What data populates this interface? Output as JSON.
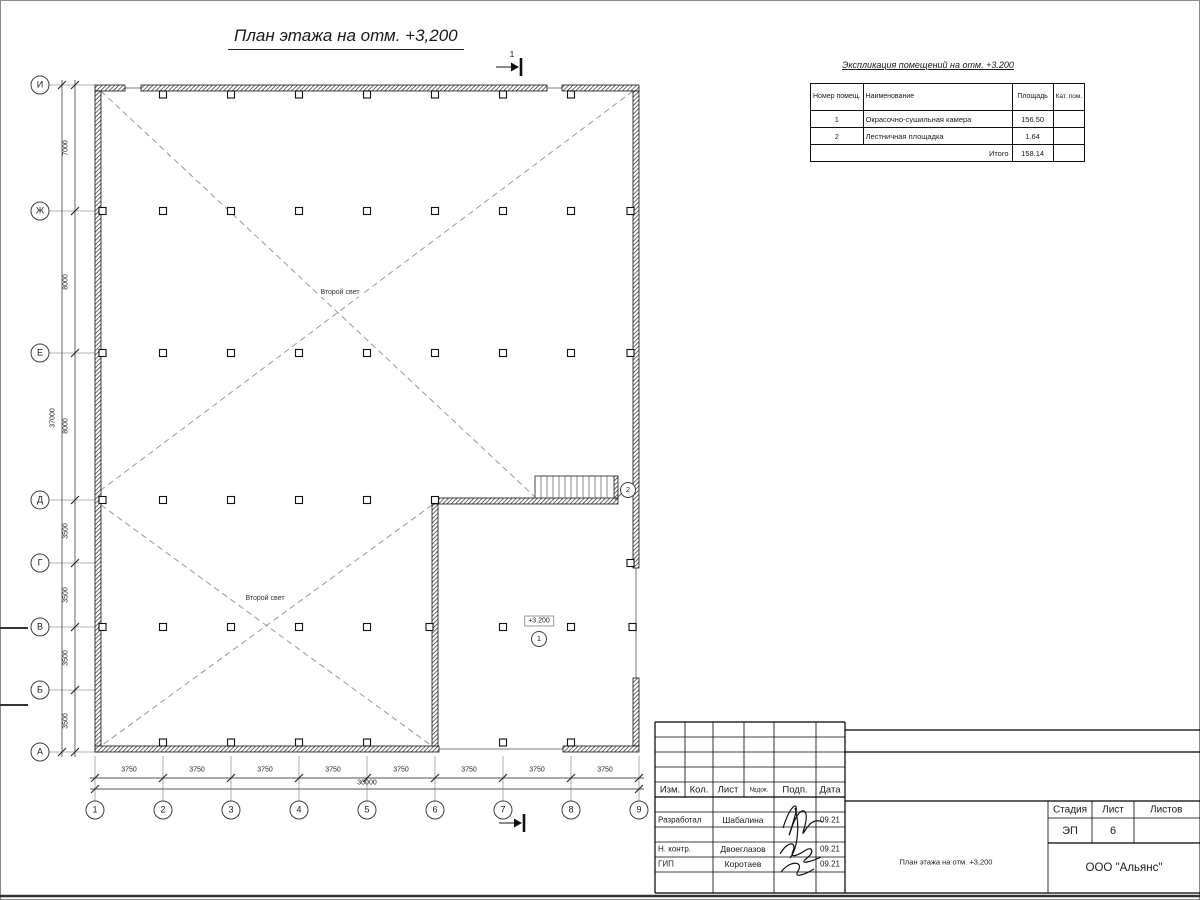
{
  "colors": {
    "line": "#1a1a1a",
    "grid": "#9a9a9a",
    "dashed": "#999999",
    "wall_hatch": "#2a2a2a"
  },
  "title": "План этажа на отм. +3,200",
  "section_mark": {
    "top": "1",
    "bottom": "1"
  },
  "plan": {
    "row_axes": [
      "И",
      "Ж",
      "Е",
      "Д",
      "Г",
      "В",
      "Б",
      "А"
    ],
    "col_axes": [
      "1",
      "2",
      "3",
      "4",
      "5",
      "6",
      "7",
      "8",
      "9"
    ],
    "row_dims": [
      "7000",
      "8000",
      "8000",
      "3500",
      "3500",
      "3500",
      "3500"
    ],
    "row_total": "37000",
    "col_dims": [
      "3750",
      "3750",
      "3750",
      "3750",
      "3750",
      "3750",
      "3750",
      "3750"
    ],
    "col_total": "30000",
    "void_label_1": "Второй свет",
    "void_label_2": "Второй свет",
    "elevation_mark": "+3.200",
    "room_mark_1": "1",
    "room_mark_2": "2"
  },
  "schedule": {
    "title": "Экспликация помещений на отм. +3.200",
    "col_headers": [
      "Номер помещ.",
      "Наименование",
      "Площадь",
      "Кат. пом."
    ],
    "rows": [
      [
        "1",
        "Окрасочно-сушильная камера",
        "156.50",
        ""
      ],
      [
        "2",
        "Лестничная площадка",
        "1.64",
        ""
      ]
    ],
    "total_label": "Итого",
    "total_value": "158.14"
  },
  "title_block": {
    "header_cols": [
      "Изм.",
      "Кол.",
      "Лист",
      "№док.",
      "Подп.",
      "Дата"
    ],
    "rows": [
      {
        "role": "Разработал",
        "name": "Шабалина",
        "date": "09.21"
      },
      {
        "role": "Н. контр.",
        "name": "Двоеглазов",
        "date": "09.21"
      },
      {
        "role": "ГИП",
        "name": "Коротаев",
        "date": "09.21"
      }
    ],
    "stage_label": "Стадия",
    "sheet_label": "Лист",
    "sheets_label": "Листов",
    "stage": "ЭП",
    "sheet": "6",
    "drawing_name": "План этажа на отм. +3,200",
    "company": "ООО \"Альянс\""
  }
}
